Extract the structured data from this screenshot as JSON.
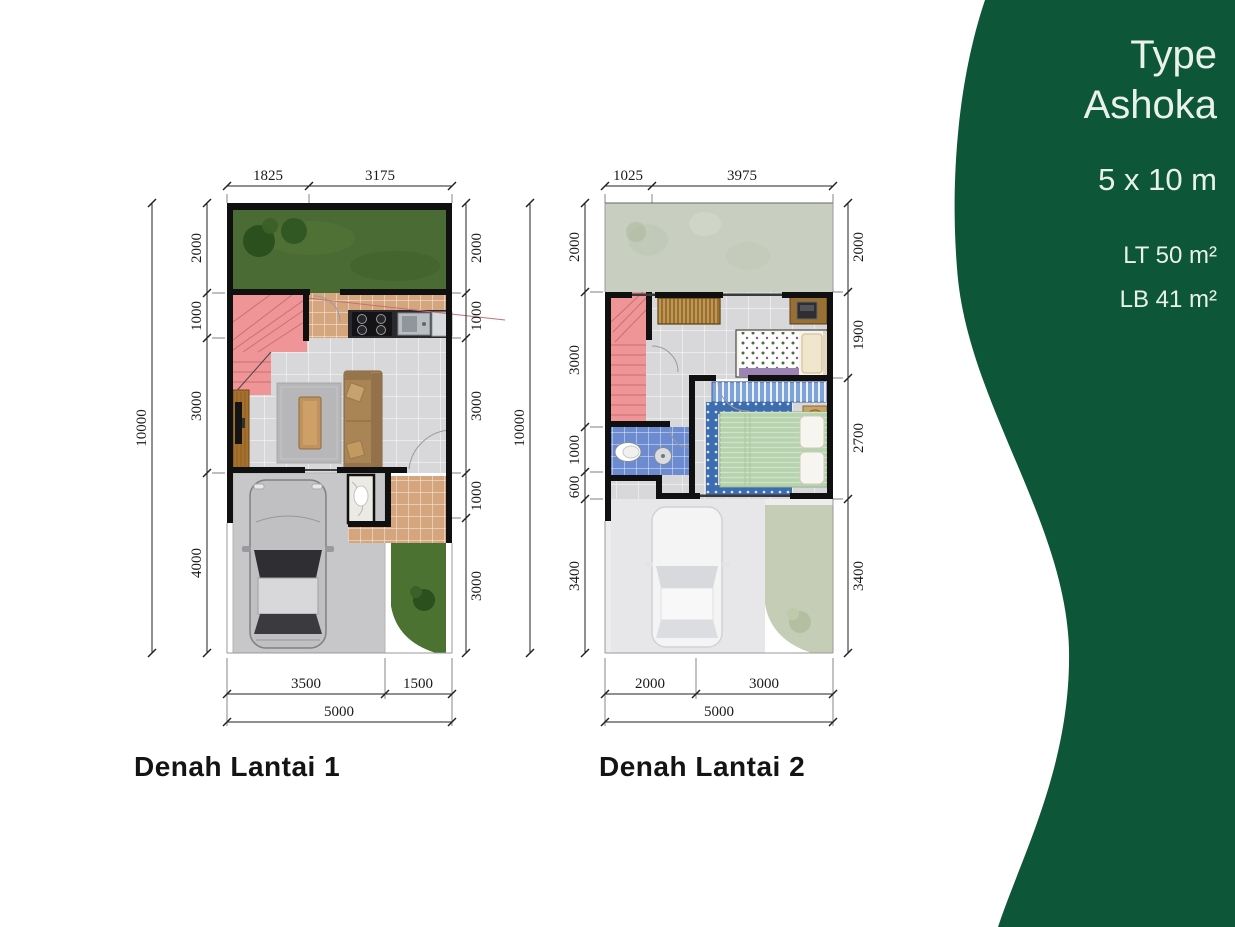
{
  "panel": {
    "title_line1": "Type",
    "title_line2": "Ashoka",
    "size": "5 x 10 m",
    "lt": "LT 50 m²",
    "lb": "LB 41 m²"
  },
  "plan1": {
    "title": "Denah Lantai 1",
    "dim_top": [
      "1825",
      "3175"
    ],
    "dim_left_total": "10000",
    "dim_left": [
      "2000",
      "1000",
      "3000",
      "4000"
    ],
    "dim_right": [
      "2000",
      "1000",
      "3000",
      "1000",
      "3000"
    ],
    "dim_bottom": [
      "3500",
      "1500"
    ],
    "dim_bottom_total": "5000"
  },
  "plan2": {
    "title": "Denah Lantai 2",
    "dim_top": [
      "1025",
      "3975"
    ],
    "dim_left_total": "10000",
    "dim_left": [
      "2000",
      "3000",
      "1000",
      "600",
      "3400"
    ],
    "dim_right": [
      "2000",
      "1900",
      "2700",
      "3400"
    ],
    "dim_bottom": [
      "2000",
      "3000"
    ],
    "dim_bottom_total": "5000"
  },
  "colors": {
    "panel_green": "#0e5638",
    "panel_text": "#e9f1ec",
    "grass": "#4a6b33",
    "grass_front": "#4c7231",
    "grass_dark": "#2c4f1e",
    "tile_gray": "#d8d8da",
    "tile_tan": "#d5a67e",
    "stairs_pink": "#ef9597",
    "wood": "#a5702c",
    "sofa": "#a98455",
    "rug": "#b7b7b9",
    "concrete": "#c7c7c9",
    "roof_sage": "#c9cfc0",
    "bathroom_blue": "#6c8bd0",
    "wardrobe_blue": "#7ea3d8",
    "bed_green": "#b7d3ae",
    "bed_border_blue": "#3e6cb0",
    "ghost_floor": "#ededee",
    "roof_green": "#c5cdb6",
    "wall_ink": "#101010"
  }
}
